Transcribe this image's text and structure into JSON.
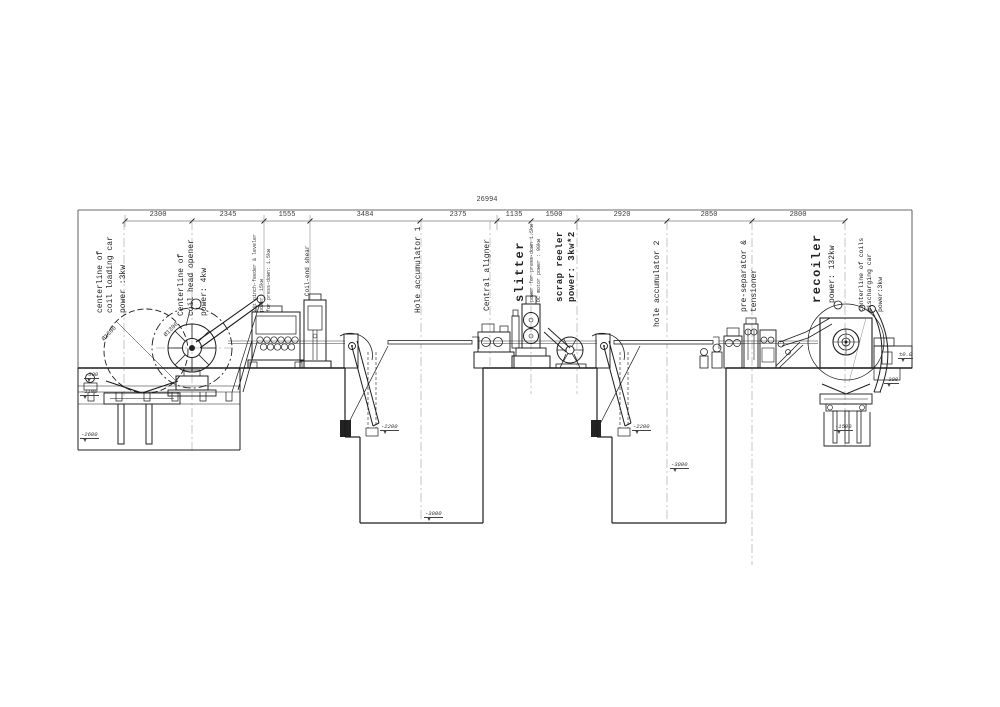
{
  "overall_dim": "26994",
  "dims": [
    "2300",
    "2345",
    "1555",
    "3484",
    "2375",
    "1135",
    "1500",
    "2920",
    "2850",
    "2800"
  ],
  "stations": {
    "loading_car": {
      "l1": "centerline of",
      "l2": "coil loading car",
      "power": "power :3kw"
    },
    "head_opener": {
      "l1": "Centerline of",
      "l2": "coil head opener",
      "power": "power: 4kw"
    },
    "pinch_feeder": {
      "l1": "24t pinch-feeder & leveler",
      "l2": "power: 15kw",
      "l3": "for press-down: 1.5kw"
    },
    "coil_end_shear": {
      "l1": "Coil-end shear"
    },
    "hole_acc_1": {
      "l1": "Hole accumulator 1"
    },
    "central_aligner": {
      "l1": "Central aligner"
    },
    "slitter": {
      "name": "slitter",
      "l1": "power for press-down 1.5kw",
      "l2": "DC motor power : 90kw"
    },
    "scrap_reeler": {
      "l1": "scrap reeler",
      "l2": "power: 3kw*2"
    },
    "hole_acc_2": {
      "l1": "hole accumulator 2"
    },
    "pre_separator": {
      "l1": "pre-separator &",
      "l2": "tensioner"
    },
    "recoiler": {
      "name": "recoiler",
      "power": "power: 132kw"
    },
    "discharging_car": {
      "l1": "centerline of coils",
      "l2": "discharging car",
      "power": "power:3kw"
    }
  },
  "elevations": [
    {
      "v": "-500"
    },
    {
      "v": "-1100"
    },
    {
      "v": "-2600"
    },
    {
      "v": "-2200"
    },
    {
      "v": "-3800"
    },
    {
      "v": "-2200"
    },
    {
      "v": "-3800"
    },
    {
      "v": "±0.0"
    },
    {
      "v": "-300"
    },
    {
      "v": "-1500"
    }
  ],
  "diameters": {
    "coil_loading": "Ø1300",
    "uncoiler": "Ø1300"
  },
  "colors": {
    "line": "#3a3a3a",
    "thick": "#1c1c1c",
    "centerline": "#8a8a8a"
  }
}
